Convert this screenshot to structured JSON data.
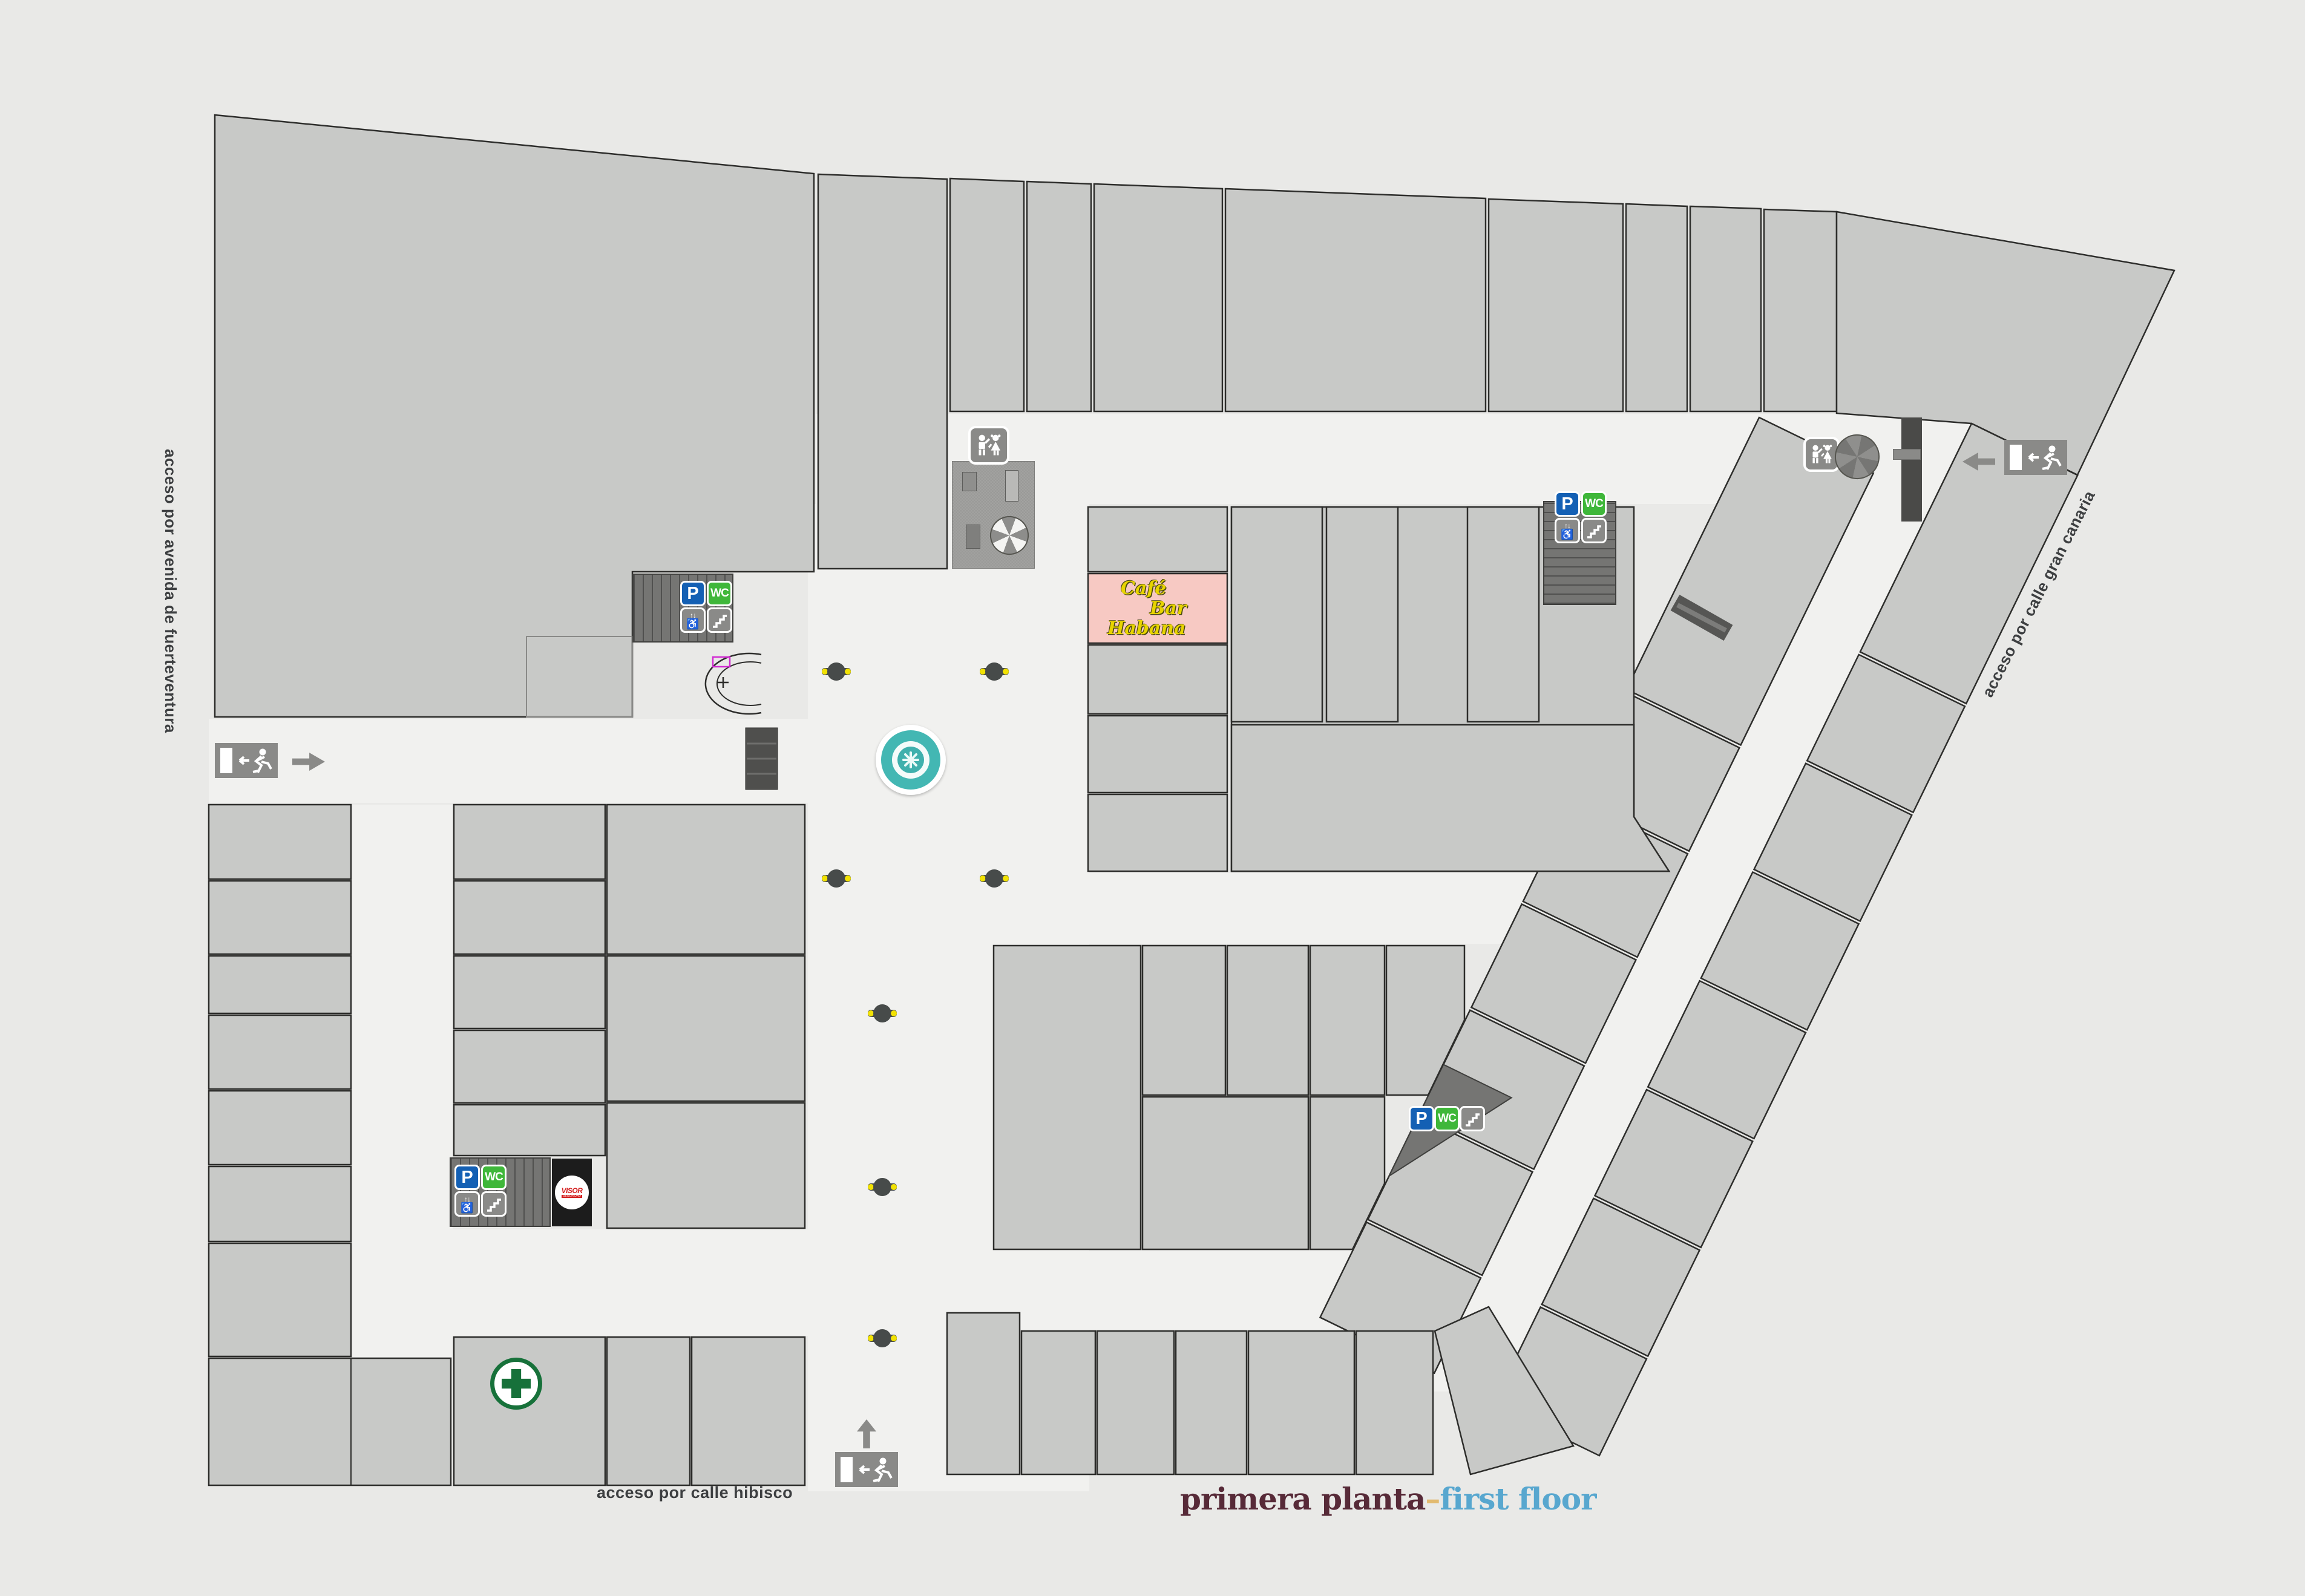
{
  "title": {
    "primary": "primera planta",
    "separator": "–",
    "secondary": "first floor"
  },
  "access_labels": {
    "west": "acceso por avenida de fuerteventura",
    "south": "acceso por calle hibisco",
    "east": "acceso por calle gran canaria"
  },
  "tenants": {
    "cafe_bar_habana": {
      "lines": [
        "Café",
        "Bar",
        "Habana"
      ]
    },
    "visor": {
      "name": "VISOR",
      "subtitle": "SEGURIDAD"
    }
  },
  "legend": {
    "parking": "P",
    "wc": "WC",
    "elevator_arrows": "↑↓",
    "wheelchair": "♿"
  },
  "icons": [
    "parking-icon",
    "wc-icon",
    "elevator-icon",
    "stairs-icon",
    "kids-area-icon",
    "exit-icon",
    "arrow-icon",
    "pharmacy-cross-icon",
    "fountain",
    "bench",
    "umbrella"
  ],
  "colors": {
    "background": "#e9e9e7",
    "corridor": "#f1f1ef",
    "unit_fill": "#c8c9c7",
    "outline": "#2d2d2b",
    "stairwell": "#757573",
    "parking_blue": "#1460b4",
    "wc_green": "#3fb73a",
    "cafe_pink": "#f7c9c3",
    "cafe_text": "#e8d400",
    "fountain_teal": "#43b7b3",
    "pharmacy_green": "#17713a",
    "bench_yellow": "#f2e203",
    "title_spanish": "#572a38",
    "title_english": "#58a7cf",
    "title_dash": "#e2ba70"
  }
}
